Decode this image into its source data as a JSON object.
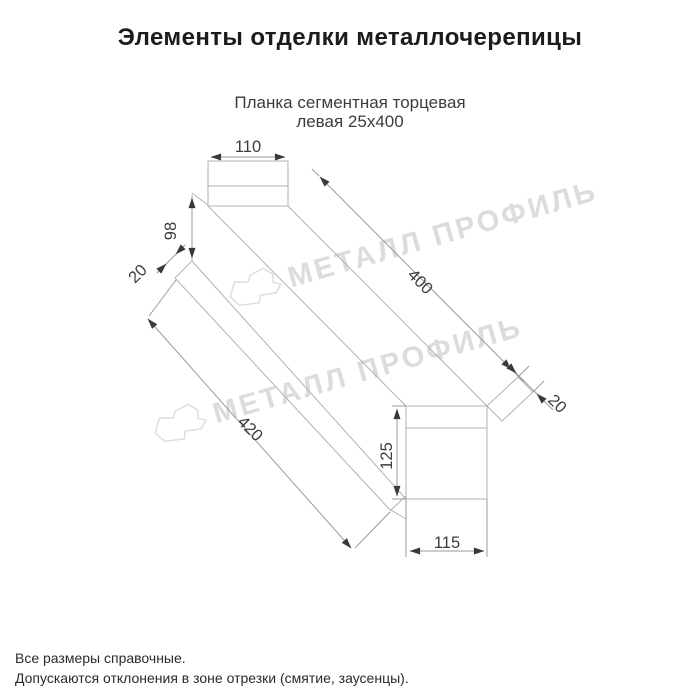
{
  "page": {
    "title": "Элементы отделки металлочерепицы"
  },
  "product": {
    "subtitle_line1": "Планка сегментная торцевая",
    "subtitle_line2": "левая 25х400"
  },
  "dimensions": {
    "top_flange_width": "110",
    "left_face_height": "98",
    "left_hem": "20",
    "top_edge_length": "400",
    "right_hem": "20",
    "bottom_edge_length": "420",
    "right_face_height": "125",
    "right_face_width": "115"
  },
  "watermark": {
    "brand": "МЕТАЛЛ ПРОФИЛЬ"
  },
  "notes": {
    "line1": "Все размеры справочные.",
    "line2": "Допускаются отклонения в зоне отрезки (смятие, заусенцы)."
  },
  "colors": {
    "background": "#ffffff",
    "title_text": "#1c1c1c",
    "subtitle_text": "#3c3c3c",
    "drawing_line": "#b2b2b2",
    "dimension_text": "#3d3d3d",
    "arrow": "#3a3a3a",
    "watermark": "#dcdcdc",
    "notes_text": "#2b2b2b"
  }
}
